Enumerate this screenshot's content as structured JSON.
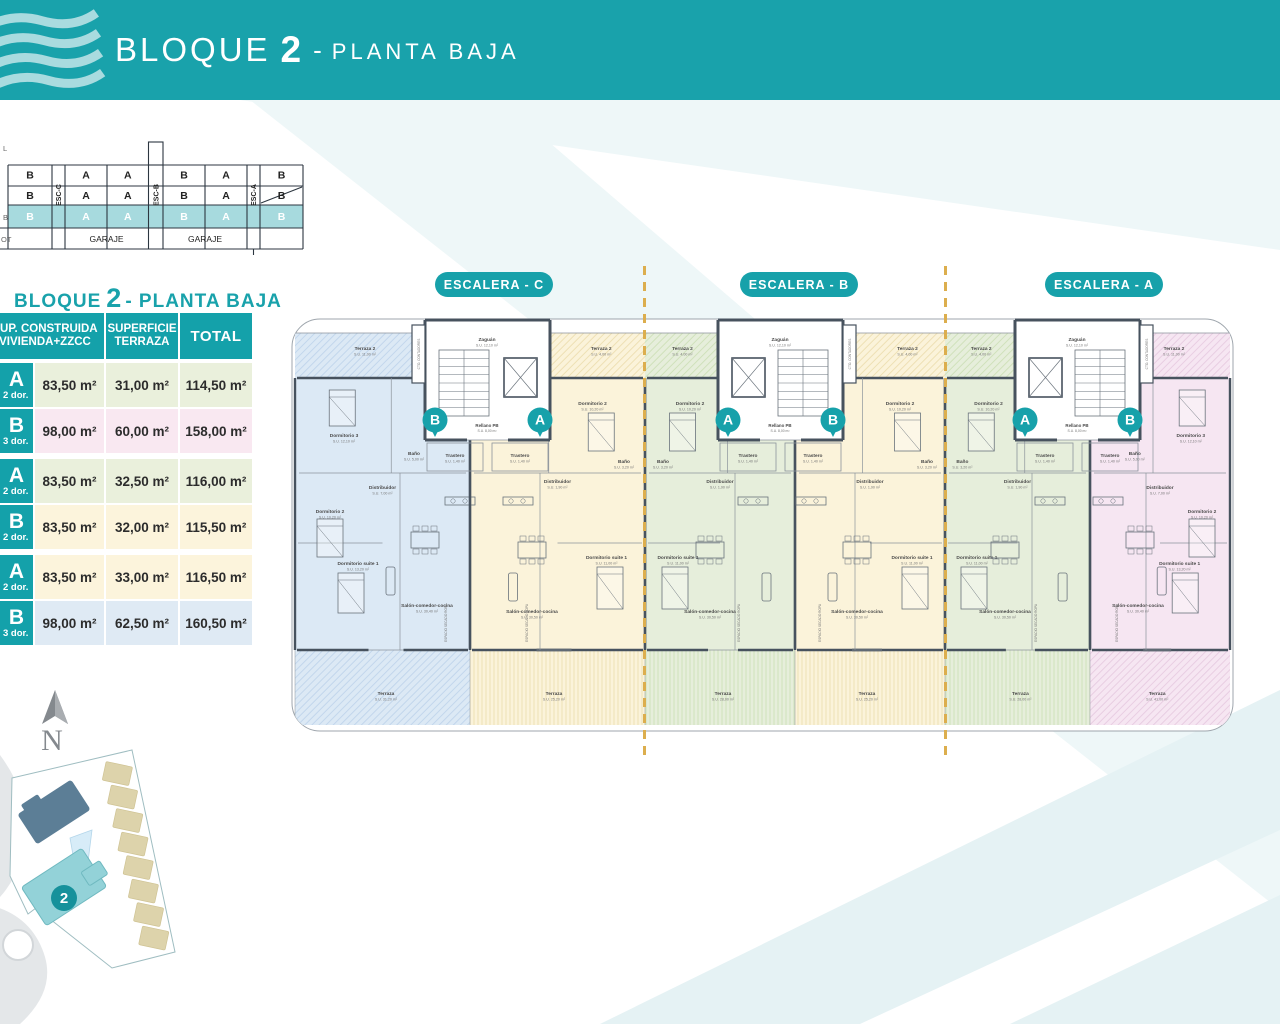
{
  "brand": {
    "teal": "#19a2ab",
    "dash_yellow": "#dcae4e",
    "wall": "#47525e"
  },
  "header": {
    "block_label": "BLOQUE",
    "block_number": "2",
    "separator": "-",
    "floor_label": "PLANTA BAJA"
  },
  "section": {
    "floor_labels_partial": [
      "L",
      "B",
      "OT"
    ],
    "esc_labels": [
      "ESC-C",
      "ESC-B",
      "ESC-A"
    ],
    "letters": [
      "B",
      "A",
      "A",
      "B",
      "A",
      "B"
    ],
    "garage_label": "GARAJE"
  },
  "legend_title": {
    "pre": "BLOQUE",
    "num": "2",
    "post": "- PLANTA BAJA"
  },
  "table": {
    "headers": {
      "col1a": "SUP. CONSTRUIDA",
      "col1b": "VIVIENDA+ZZCC",
      "col2a": "SUPERFICIE",
      "col2b": "TERRAZA",
      "col3": "TOTAL"
    },
    "rows": [
      {
        "type": "A",
        "dorm": "2 dor.",
        "built": "83,50 m²",
        "terrace": "31,00 m²",
        "total": "114,50 m²",
        "bg": "#eaf0dc"
      },
      {
        "type": "B",
        "dorm": "3 dor.",
        "built": "98,00 m²",
        "terrace": "60,00 m²",
        "total": "158,00 m²",
        "bg": "#f9e8f1"
      },
      {
        "type": "A",
        "dorm": "2 dor.",
        "built": "83,50 m²",
        "terrace": "32,50 m²",
        "total": "116,00 m²",
        "bg": "#eaf0dc"
      },
      {
        "type": "B",
        "dorm": "2 dor.",
        "built": "83,50 m²",
        "terrace": "32,00 m²",
        "total": "115,50 m²",
        "bg": "#fcf4dc"
      },
      {
        "type": "A",
        "dorm": "2 dor.",
        "built": "83,50 m²",
        "terrace": "33,00 m²",
        "total": "116,50 m²",
        "bg": "#fcf4dc"
      },
      {
        "type": "B",
        "dorm": "3 dor.",
        "built": "98,00 m²",
        "terrace": "62,50 m²",
        "total": "160,50 m²",
        "bg": "#dfeaf4"
      }
    ]
  },
  "plan": {
    "escaleras": [
      "ESCALERA - C",
      "ESCALERA - B",
      "ESCALERA - A"
    ],
    "badges": [
      [
        "B",
        "A"
      ],
      [
        "A",
        "B"
      ],
      [
        "A",
        "B"
      ]
    ],
    "core": {
      "zaguan": "Zaguán",
      "zaguan_area": "S.U. 12,10 m²",
      "rellano": "Rellano PB",
      "rellano_area": "S.U. 8,00 m²",
      "utility": "CTO. CONTADORES"
    },
    "units": [
      {
        "id": "esc-c-vivienda-b",
        "color": "#dce9f5",
        "hatch": "#b7cfe8",
        "rooms": {
          "terraza2": [
            "Terraza 2",
            "S.U. 11,00 m²"
          ],
          "dorm3": [
            "Dormitorio 3",
            "S.U. 12,10 m²"
          ],
          "bano": [
            "Baño",
            "S.U. 5,00 m²"
          ],
          "distribuidor": [
            "Distribuidor",
            "S.U. 7,00 m²"
          ],
          "dorm2": [
            "Dormitorio 2",
            "S.U. 10,20 m²"
          ],
          "suite": [
            "Dormitorio suite 1",
            "S.U. 13,20 m²"
          ],
          "salon": [
            "Salón-comedor-cocina",
            "S.U. 30,40 m²"
          ],
          "trastero": [
            "Trastero",
            "S.U. 1,40 m²"
          ],
          "terraza": [
            "Terraza",
            "S.U. 31,20 m²"
          ],
          "secado": "ESPACIO SECADO ROPA"
        }
      },
      {
        "id": "esc-c-vivienda-a",
        "color": "#fbf3da",
        "hatch": "#e8d9a4",
        "rooms": {
          "terraza2": [
            "Terraza 2",
            "S.U. 4,00 m²"
          ],
          "dorm2": [
            "Dormitorio 2",
            "S.U. 10,20 m²"
          ],
          "bano": [
            "Baño",
            "S.U. 3,20 m²"
          ],
          "distribuidor": [
            "Distribuidor",
            "S.U. 1,90 m²"
          ],
          "suite": [
            "Dormitorio suite 1",
            "S.U. 11,00 m²"
          ],
          "salon": [
            "Salón-comedor-cocina",
            "S.U. 30,50 m²"
          ],
          "trastero": [
            "Trastero",
            "S.U. 1,40 m²"
          ],
          "terraza": [
            "Terraza",
            "S.U. 25,20 m²"
          ],
          "secado": "ESPACIO SECADO ROPA"
        }
      },
      {
        "id": "esc-b-vivienda-a",
        "color": "#e6eedb",
        "hatch": "#c6dcae",
        "rooms": {
          "terraza2": [
            "Terraza 2",
            "S.U. 4,00 m²"
          ],
          "dorm2": [
            "Dormitorio 2",
            "S.U. 10,20 m²"
          ],
          "bano": [
            "Baño",
            "S.U. 3,20 m²"
          ],
          "distribuidor": [
            "Distribuidor",
            "S.U. 1,90 m²"
          ],
          "suite": [
            "Dormitorio suite 1",
            "S.U. 11,00 m²"
          ],
          "salon": [
            "Salón-comedor-cocina",
            "S.U. 30,50 m²"
          ],
          "trastero": [
            "Trastero",
            "S.U. 1,40 m²"
          ],
          "terraza": [
            "Terraza",
            "S.U. 28,00 m²"
          ],
          "secado": "ESPACIO SECADO ROPA"
        }
      },
      {
        "id": "esc-b-vivienda-b",
        "color": "#fbf3da",
        "hatch": "#e8d9a4",
        "rooms": {
          "terraza2": [
            "Terraza 2",
            "S.U. 4,00 m²"
          ],
          "dorm2": [
            "Dormitorio 2",
            "S.U. 10,20 m²"
          ],
          "bano": [
            "Baño",
            "S.U. 3,20 m²"
          ],
          "distribuidor": [
            "Distribuidor",
            "S.U. 1,90 m²"
          ],
          "suite": [
            "Dormitorio suite 1",
            "S.U. 11,00 m²"
          ],
          "salon": [
            "Salón-comedor-cocina",
            "S.U. 30,50 m²"
          ],
          "trastero": [
            "Trastero",
            "S.U. 1,40 m²"
          ],
          "terraza": [
            "Terraza",
            "S.U. 25,20 m²"
          ],
          "secado": "ESPACIO SECADO ROPA"
        }
      },
      {
        "id": "esc-a-vivienda-a",
        "color": "#e6eedb",
        "hatch": "#c6dcae",
        "rooms": {
          "terraza2": [
            "Terraza 2",
            "S.U. 4,00 m²"
          ],
          "dorm2": [
            "Dormitorio 2",
            "S.U. 10,20 m²"
          ],
          "bano": [
            "Baño",
            "S.U. 3,20 m²"
          ],
          "distribuidor": [
            "Distribuidor",
            "S.U. 1,90 m²"
          ],
          "suite": [
            "Dormitorio suite 1",
            "S.U. 11,00 m²"
          ],
          "salon": [
            "Salón-comedor-cocina",
            "S.U. 30,50 m²"
          ],
          "trastero": [
            "Trastero",
            "S.U. 1,40 m²"
          ],
          "terraza": [
            "Terraza",
            "S.U. 28,00 m²"
          ],
          "secado": "ESPACIO SECADO ROPA"
        }
      },
      {
        "id": "esc-a-vivienda-b",
        "color": "#f6e6f2",
        "hatch": "#e3c3dc",
        "rooms": {
          "terraza2": [
            "Terraza 2",
            "S.U. 11,00 m²"
          ],
          "dorm3": [
            "Dormitorio 3",
            "S.U. 12,10 m²"
          ],
          "bano": [
            "Baño",
            "S.U. 5,00 m²"
          ],
          "distribuidor": [
            "Distribuidor",
            "S.U. 7,00 m²"
          ],
          "dorm2": [
            "Dormitorio 2",
            "S.U. 10,20 m²"
          ],
          "suite": [
            "Dormitorio suite 1",
            "S.U. 13,20 m²"
          ],
          "salon": [
            "Salón-comedor-cocina",
            "S.U. 30,40 m²"
          ],
          "trastero": [
            "Trastero",
            "S.U. 1,40 m²"
          ],
          "terraza": [
            "Terraza",
            "S.U. 41,00 m²"
          ],
          "secado": "ESPACIO SECADO ROPA"
        }
      }
    ]
  },
  "site": {
    "north": "N",
    "block_badge": "2"
  }
}
